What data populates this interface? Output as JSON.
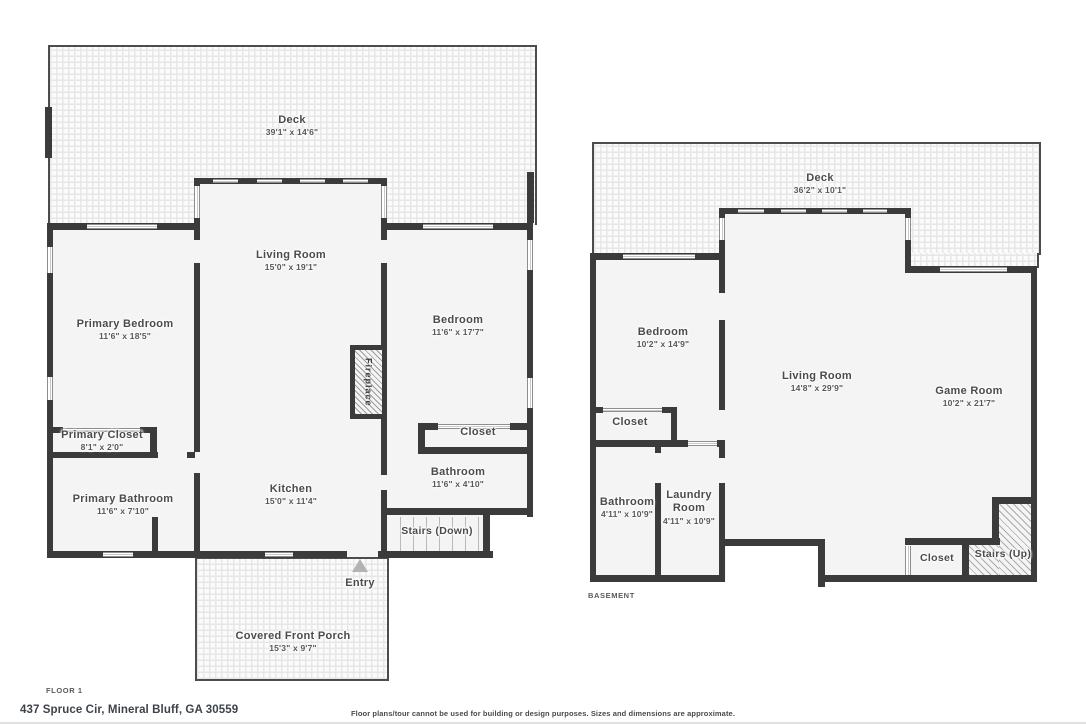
{
  "floor1": {
    "caption": "FLOOR 1",
    "rooms": {
      "deck": {
        "name": "Deck",
        "dims": "39'1\" x 14'6\""
      },
      "living_room": {
        "name": "Living Room",
        "dims": "15'0\" x 19'1\""
      },
      "primary_bedroom": {
        "name": "Primary Bedroom",
        "dims": "11'6\" x 18'5\""
      },
      "bedroom": {
        "name": "Bedroom",
        "dims": "11'6\" x 17'7\""
      },
      "primary_closet": {
        "name": "Primary Closet",
        "dims": "8'1\" x 2'0\""
      },
      "primary_bathroom": {
        "name": "Primary Bathroom",
        "dims": "11'6\" x 7'10\""
      },
      "kitchen": {
        "name": "Kitchen",
        "dims": "15'0\" x 11'4\""
      },
      "closet": {
        "name": "Closet"
      },
      "bathroom": {
        "name": "Bathroom",
        "dims": "11'6\" x 4'10\""
      },
      "stairs": {
        "name": "Stairs (Down)"
      },
      "fireplace": {
        "name": "Fireplace"
      },
      "entry": {
        "name": "Entry"
      },
      "covered_front_porch": {
        "name": "Covered Front Porch",
        "dims": "15'3\" x 9'7\""
      }
    }
  },
  "basement": {
    "caption": "BASEMENT",
    "rooms": {
      "deck": {
        "name": "Deck",
        "dims": "36'2\" x 10'1\""
      },
      "bedroom": {
        "name": "Bedroom",
        "dims": "10'2\" x 14'9\""
      },
      "closet": {
        "name": "Closet"
      },
      "bathroom": {
        "name": "Bathroom",
        "dims": "4'11\" x 10'9\""
      },
      "laundry_room": {
        "name": "Laundry Room",
        "dims": "4'11\" x 10'9\""
      },
      "living_room": {
        "name": "Living Room",
        "dims": "14'8\" x 29'9\""
      },
      "game_room": {
        "name": "Game Room",
        "dims": "10'2\" x 21'7\""
      },
      "closet2": {
        "name": "Closet"
      },
      "stairs": {
        "name": "Stairs (Up)"
      }
    }
  },
  "footer": {
    "address": "437 Spruce Cir, Mineral Bluff, GA 30559",
    "disclaimer": "Floor plans/tour cannot be used for building or design purposes. Sizes and dimensions are approximate."
  },
  "colors": {
    "wall": "#3b3b3b",
    "room_label": "#4b4b4b",
    "dims_label": "#585858",
    "entry_arrow": "#b3b3b3"
  }
}
